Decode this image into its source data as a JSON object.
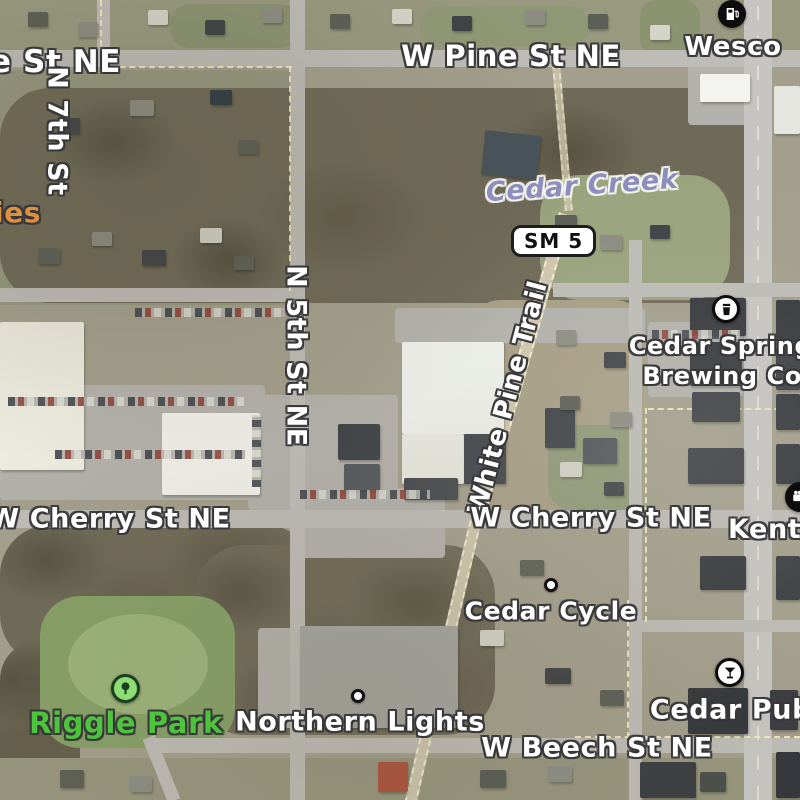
{
  "map": {
    "view": "satellite",
    "road_labels": {
      "pine_partial": "e St NE",
      "pine": "W Pine St NE",
      "n7th": "N 7th St",
      "n5th": "N 5th St NE",
      "cherry_left": "W Cherry St NE",
      "cherry_right": "W Cherry St NE",
      "beech": "W Beech St NE",
      "white_pine_trail": "White Pine Trail"
    },
    "water_labels": {
      "cedar_creek": "Cedar Creek"
    },
    "route_badges": {
      "sm5": "SM 5"
    },
    "pois": {
      "wesco": {
        "name": "Wesco",
        "icon": "fuel-pump"
      },
      "cedar_springs_brewing": {
        "line1": "Cedar Springs",
        "line2": "Brewing Co.",
        "icon": "beer"
      },
      "kent_theatre_partial": {
        "name": "Kent Th",
        "icon": "movie-camera"
      },
      "cedar_cycle": {
        "name": "Cedar Cycle",
        "marker": "dot"
      },
      "northern_lights": {
        "name": "Northern Lights",
        "marker": "dot"
      },
      "cedar_pub": {
        "name": "Cedar Pub",
        "icon": "cocktail"
      },
      "riggle_park": {
        "name": "Riggle Park",
        "icon": "tree"
      },
      "left_edge_partial": {
        "name": "ies"
      }
    },
    "colors": {
      "park_label": "#4cc43c",
      "partial_poi_orange": "#dd9140",
      "water_label": "#8d8dbe",
      "boundary_dash": "#f2e9bd"
    }
  }
}
